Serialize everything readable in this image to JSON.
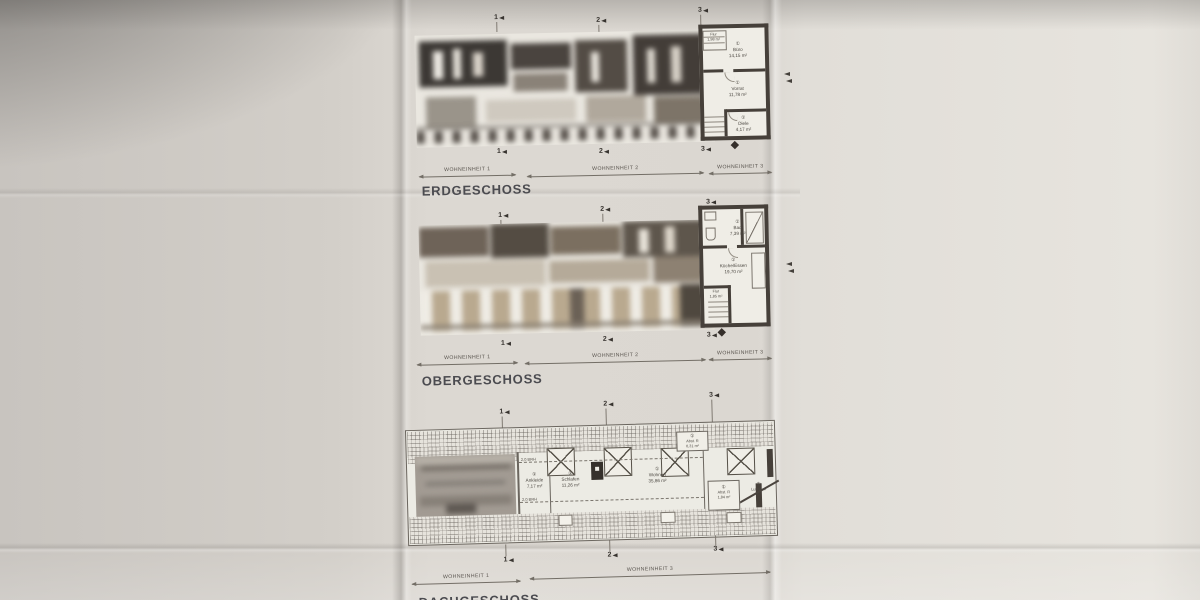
{
  "colors": {
    "paper": "#dcd8d2",
    "wall": "#46403a",
    "ink": "#4c4842",
    "title_ink": "#4b4b50"
  },
  "floors": [
    {
      "title": "ERDGESCHOSS",
      "markers_top": [
        "1",
        "2",
        "3"
      ],
      "markers_bottom": [
        "1",
        "2",
        "3"
      ],
      "units": [
        {
          "label": "WOHNEINHEIT 1"
        },
        {
          "label": "WOHNEINHEIT 2"
        },
        {
          "label": "WOHNEINHEIT 3"
        }
      ],
      "rooms": [
        {
          "tag": "①",
          "name": "Flur",
          "area": "1,98 m²"
        },
        {
          "tag": "①",
          "name": "Büro",
          "area": "14,15 m²"
        },
        {
          "tag": "①",
          "name": "Vorrat",
          "area": "11,78 m²"
        },
        {
          "tag": "①",
          "name": "Diele",
          "area": "4,17 m²"
        }
      ]
    },
    {
      "title": "OBERGESCHOSS",
      "markers_top": [
        "1",
        "2",
        "3"
      ],
      "markers_bottom": [
        "1",
        "2",
        "3"
      ],
      "units": [
        {
          "label": "WOHNEINHEIT 1"
        },
        {
          "label": "WOHNEINHEIT 2"
        },
        {
          "label": "WOHNEINHEIT 3"
        }
      ],
      "rooms": [
        {
          "tag": "①",
          "name": "Bad",
          "area": "7,39 m²"
        },
        {
          "tag": "①",
          "name": "Küche/Essen",
          "area": "19,70 m²"
        },
        {
          "tag": "①",
          "name": "Flur",
          "area": "1,85 m²"
        }
      ]
    },
    {
      "title": "DACHGESCHOSS",
      "markers_top": [
        "1",
        "2",
        "3"
      ],
      "markers_bottom": [
        "1",
        "2",
        "3"
      ],
      "units": [
        {
          "label": "WOHNEINHEIT 1"
        },
        {
          "label": "WOHNEINHEIT 3"
        }
      ],
      "rooms": [
        {
          "tag": "①",
          "name": "Ankleide",
          "area": "7,17 m²"
        },
        {
          "tag": "①",
          "name": "Schlafen",
          "area": "11,26 m²"
        },
        {
          "tag": "①",
          "name": "Wohnen",
          "area": "35,86 m²"
        },
        {
          "tag": "①",
          "name": "Abst. R",
          "area": "0,31 m²"
        },
        {
          "tag": "①",
          "name": "Abst. R",
          "area": "1,84 m²"
        },
        {
          "tag": "①",
          "name": "Luftraum",
          "area": ""
        }
      ],
      "height_lines": [
        {
          "label": "2,0 BRH"
        },
        {
          "label": "2,0 BRH"
        }
      ]
    }
  ]
}
